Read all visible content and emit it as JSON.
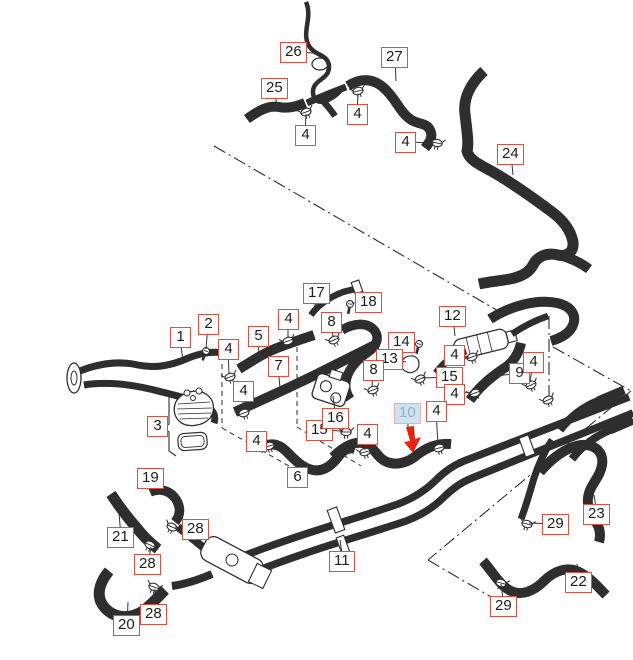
{
  "diagram": {
    "type": "exploded-parts-hose-diagram",
    "highlighted_part": "10",
    "colors": {
      "callout_border": "#dd4f41",
      "callout_text": "#1d1d1d",
      "highlight_bg": "#cfe2f1",
      "highlight_text": "#97aec3",
      "highlight_border": "#eeb0a8",
      "arrow": "#e62310",
      "line_art": "#2e2e2e",
      "background": "#ffffff"
    },
    "callouts": [
      {
        "label": "26",
        "x": 280,
        "y": 42,
        "tx": 313,
        "ty": 53
      },
      {
        "label": "25",
        "x": 261,
        "y": 78,
        "tx": 277,
        "ty": 111
      },
      {
        "label": "4",
        "x": 295,
        "y": 125,
        "tx": 306,
        "ty": 114
      },
      {
        "label": "27",
        "x": 381,
        "y": 47,
        "tx": 396,
        "ty": 81
      },
      {
        "label": "4",
        "x": 347,
        "y": 104,
        "tx": 358,
        "ty": 94
      },
      {
        "label": "4",
        "x": 395,
        "y": 132,
        "tx": 434,
        "ty": 143
      },
      {
        "label": "24",
        "x": 497,
        "y": 144,
        "tx": 513,
        "ty": 175
      },
      {
        "label": "1",
        "x": 170,
        "y": 327,
        "tx": 183,
        "ty": 362
      },
      {
        "label": "2",
        "x": 198,
        "y": 314,
        "tx": 206,
        "ty": 349
      },
      {
        "label": "4",
        "x": 218,
        "y": 339,
        "tx": 229,
        "ty": 374
      },
      {
        "label": "5",
        "x": 248,
        "y": 326,
        "tx": 259,
        "ty": 356
      },
      {
        "label": "4",
        "x": 278,
        "y": 309,
        "tx": 288,
        "ty": 338
      },
      {
        "label": "17",
        "x": 303,
        "y": 283,
        "tx": 314,
        "ty": 311
      },
      {
        "label": "18",
        "x": 355,
        "y": 292,
        "tx": 352,
        "ty": 303
      },
      {
        "label": "8",
        "x": 321,
        "y": 312,
        "tx": 333,
        "ty": 337
      },
      {
        "label": "7",
        "x": 268,
        "y": 356,
        "tx": 280,
        "ty": 388
      },
      {
        "label": "4",
        "x": 233,
        "y": 381,
        "tx": 243,
        "ty": 410
      },
      {
        "label": "3",
        "x": 147,
        "y": 416,
        "tx": 163,
        "ty": 428
      },
      {
        "label": "4",
        "x": 246,
        "y": 431,
        "tx": 267,
        "ty": 444
      },
      {
        "label": "15",
        "x": 306,
        "y": 420,
        "tx": 343,
        "ty": 431
      },
      {
        "label": "16",
        "x": 322,
        "y": 408,
        "tx": 333,
        "ty": 396
      },
      {
        "label": "6",
        "x": 287,
        "y": 467,
        "tx": 297,
        "ty": 455
      },
      {
        "label": "12",
        "x": 439,
        "y": 306,
        "tx": 455,
        "ty": 336
      },
      {
        "label": "14",
        "x": 388,
        "y": 332,
        "tx": 415,
        "ty": 344
      },
      {
        "label": "13",
        "x": 376,
        "y": 349,
        "tx": 406,
        "ty": 362
      },
      {
        "label": "8",
        "x": 363,
        "y": 360,
        "tx": 372,
        "ty": 387
      },
      {
        "label": "4",
        "x": 444,
        "y": 345,
        "tx": 469,
        "ty": 357
      },
      {
        "label": "15",
        "x": 436,
        "y": 367,
        "tx": 422,
        "ty": 378
      },
      {
        "label": "4",
        "x": 444,
        "y": 384,
        "tx": 472,
        "ty": 392
      },
      {
        "label": "4",
        "x": 426,
        "y": 401,
        "tx": 438,
        "ty": 445
      },
      {
        "label": "9",
        "x": 509,
        "y": 363,
        "tx": 489,
        "ty": 377
      },
      {
        "label": "4",
        "x": 523,
        "y": 352,
        "tx": 530,
        "ty": 382
      },
      {
        "label": "10",
        "x": 394,
        "y": 403,
        "tx": 408,
        "ty": 427,
        "highlighted": true
      },
      {
        "label": "4",
        "x": 357,
        "y": 424,
        "tx": 365,
        "ty": 450
      },
      {
        "label": "11",
        "x": 329,
        "y": 551,
        "tx": 340,
        "ty": 540
      },
      {
        "label": "19",
        "x": 137,
        "y": 468,
        "tx": 151,
        "ty": 490
      },
      {
        "label": "21",
        "x": 107,
        "y": 527,
        "tx": 119,
        "ty": 513
      },
      {
        "label": "28",
        "x": 182,
        "y": 519,
        "tx": 175,
        "ty": 527
      },
      {
        "label": "28",
        "x": 134,
        "y": 554,
        "tx": 151,
        "ty": 547
      },
      {
        "label": "28",
        "x": 140,
        "y": 604,
        "tx": 155,
        "ty": 589
      },
      {
        "label": "20",
        "x": 113,
        "y": 615,
        "tx": 128,
        "ty": 602
      },
      {
        "label": "23",
        "x": 583,
        "y": 504,
        "tx": 594,
        "ty": 495
      },
      {
        "label": "29",
        "x": 542,
        "y": 514,
        "tx": 529,
        "ty": 523
      },
      {
        "label": "22",
        "x": 565,
        "y": 572,
        "tx": 577,
        "ty": 564
      },
      {
        "label": "29",
        "x": 490,
        "y": 596,
        "tx": 501,
        "ty": 584
      }
    ],
    "arrow": {
      "x": 404,
      "y": 427
    }
  }
}
